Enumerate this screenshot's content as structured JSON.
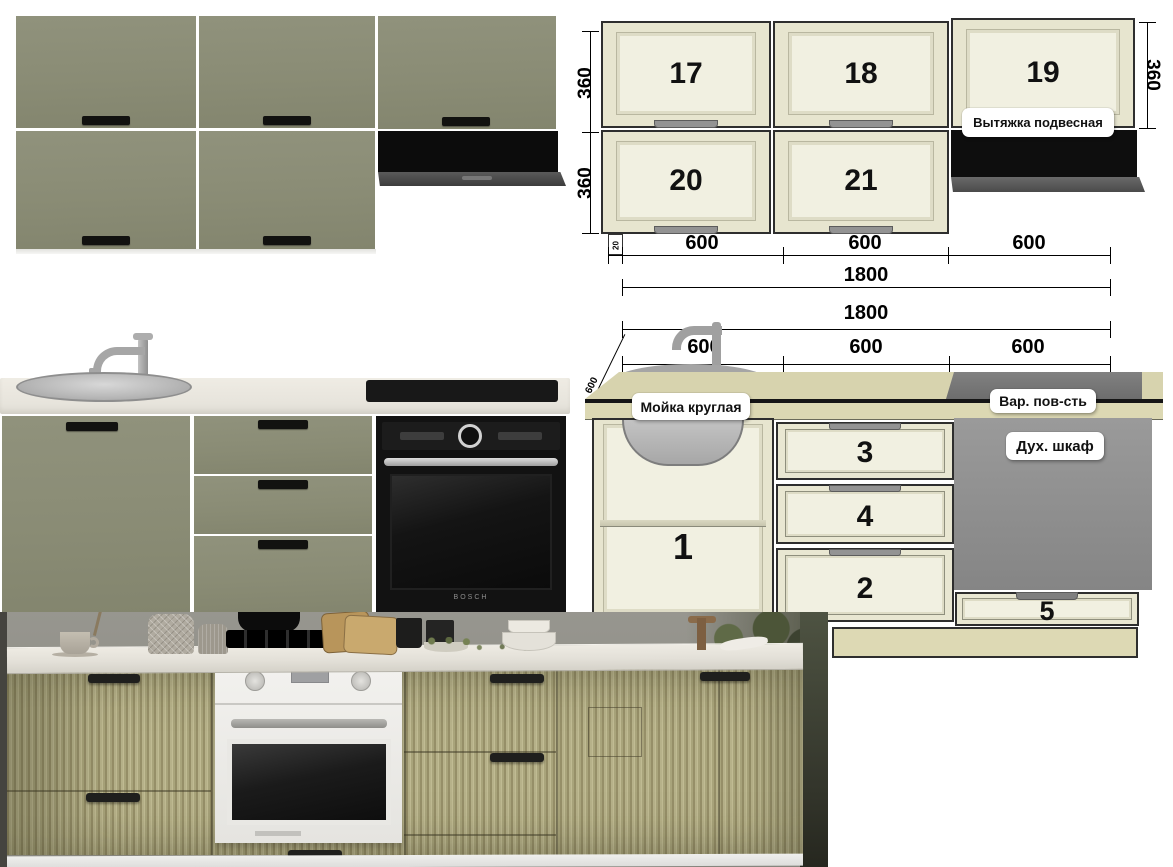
{
  "colors": {
    "sage_door": "#8b8d76",
    "diagram_cream": "#f1f0e1",
    "diagram_frame": "#e7e5cf",
    "counter_beige": "#d7d3ae",
    "plinth_beige": "#ddd9b4",
    "oven_gray": "#8d8d8d",
    "hood_black": "#0e0e0e",
    "photo_khaki": "#b2ad85",
    "marble_counter": "#eae7df"
  },
  "upper_diagram": {
    "panels": [
      {
        "number": "17"
      },
      {
        "number": "18"
      },
      {
        "number": "19"
      },
      {
        "number": "20"
      },
      {
        "number": "21"
      }
    ],
    "hood_label": "Вытяжка подвесная",
    "dims": {
      "left_top": "360",
      "left_bottom": "360",
      "right": "360",
      "small": "20",
      "w1": "600",
      "w2": "600",
      "w3": "600",
      "total": "1800"
    }
  },
  "lower_diagram": {
    "labels": {
      "sink": "Мойка круглая",
      "hob": "Вар. пов-сть",
      "oven": "Дух. шкаф"
    },
    "units": {
      "open_cabinet": "1",
      "drawer_top": "3",
      "drawer_middle": "4",
      "drawer_bottom": "2",
      "oven_drawer": "5"
    },
    "dims": {
      "total": "1800",
      "w1": "600",
      "w2": "600",
      "w3": "600",
      "depth": "600"
    }
  },
  "base_render": {
    "oven_brand": "BOSCH"
  }
}
